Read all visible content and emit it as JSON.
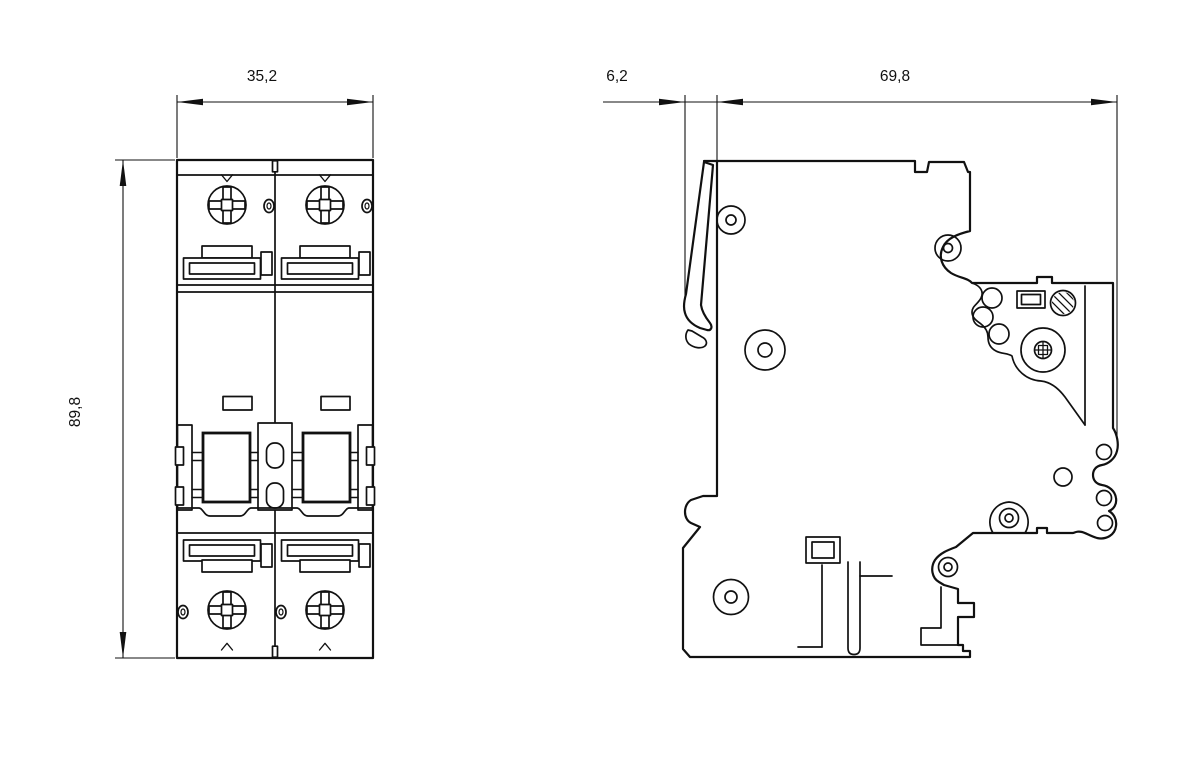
{
  "drawing": {
    "background_color": "#ffffff",
    "line_color": "#111111",
    "front_view": {
      "width_dim": "35,2",
      "height_dim": "89,8"
    },
    "side_view": {
      "clip_offset_dim": "6,2",
      "depth_dim": "69,8"
    }
  }
}
